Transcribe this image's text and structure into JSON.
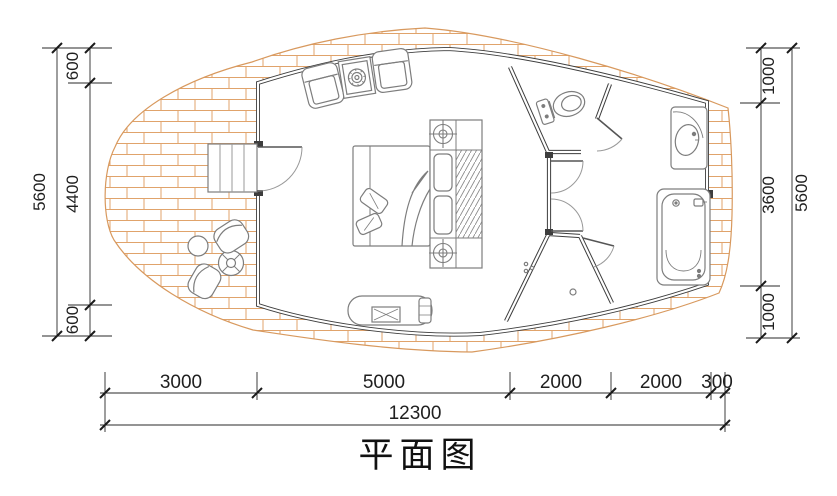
{
  "title": "平面图",
  "dimensions": {
    "left": {
      "segments": [
        "600",
        "4400",
        "600"
      ],
      "total": "5600"
    },
    "right": {
      "segments": [
        "1000",
        "3600",
        "1000"
      ],
      "total": "5600"
    },
    "bottom": {
      "segments": [
        "3000",
        "5000",
        "2000",
        "2000",
        "300"
      ],
      "total": "12300"
    }
  },
  "colors": {
    "brick_line": "#e0a36b",
    "deck_edge": "#d8995e",
    "wall": "#3d3d3d",
    "furniture": "#7d7d7d",
    "dimension": "#1f1f1f"
  }
}
